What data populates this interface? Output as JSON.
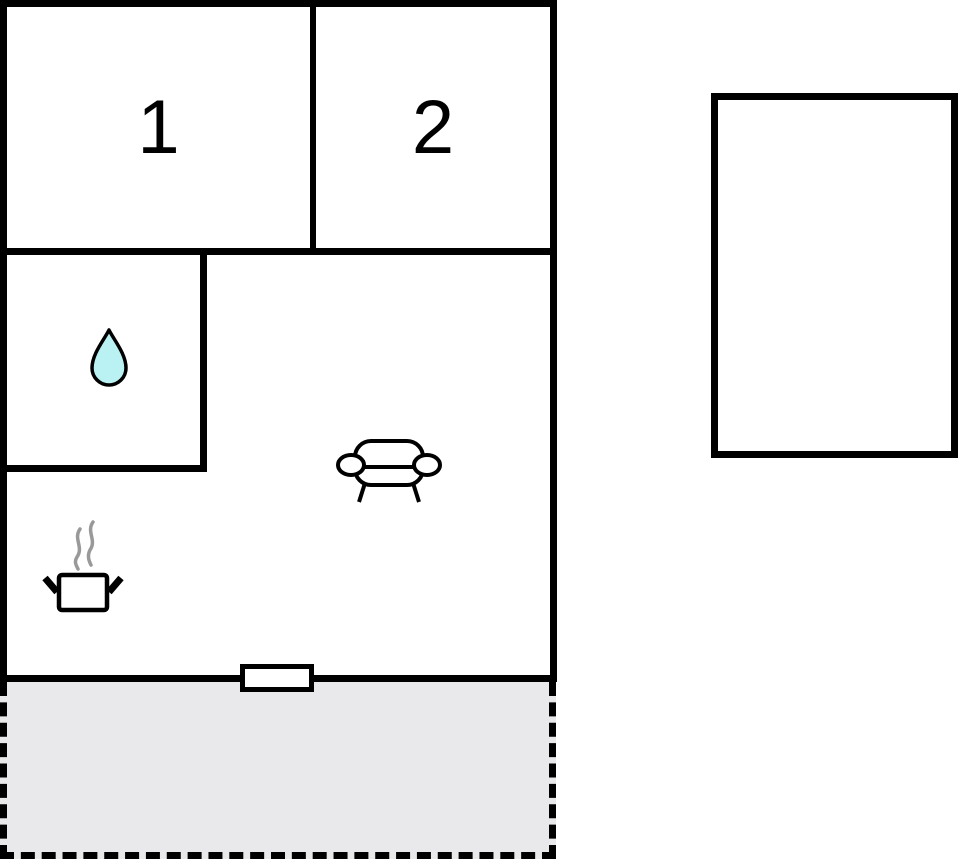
{
  "floor_plan": {
    "rooms": [
      {
        "label": "1"
      },
      {
        "label": "2"
      }
    ],
    "icons": [
      {
        "name": "water-drop-icon"
      },
      {
        "name": "steaming-pot-icon"
      },
      {
        "name": "sofa-icon"
      }
    ],
    "markers": {
      "door_marker": "door-window-opening",
      "terrace": "dashed-terrace-area",
      "annex": "detached-outbuilding-rectangle"
    },
    "colors": {
      "wall": "#000000",
      "floor": "#ffffff",
      "terrace_fill": "#e9e9eb",
      "water_drop_fill": "#baf2f4",
      "steam": "#999999"
    }
  }
}
